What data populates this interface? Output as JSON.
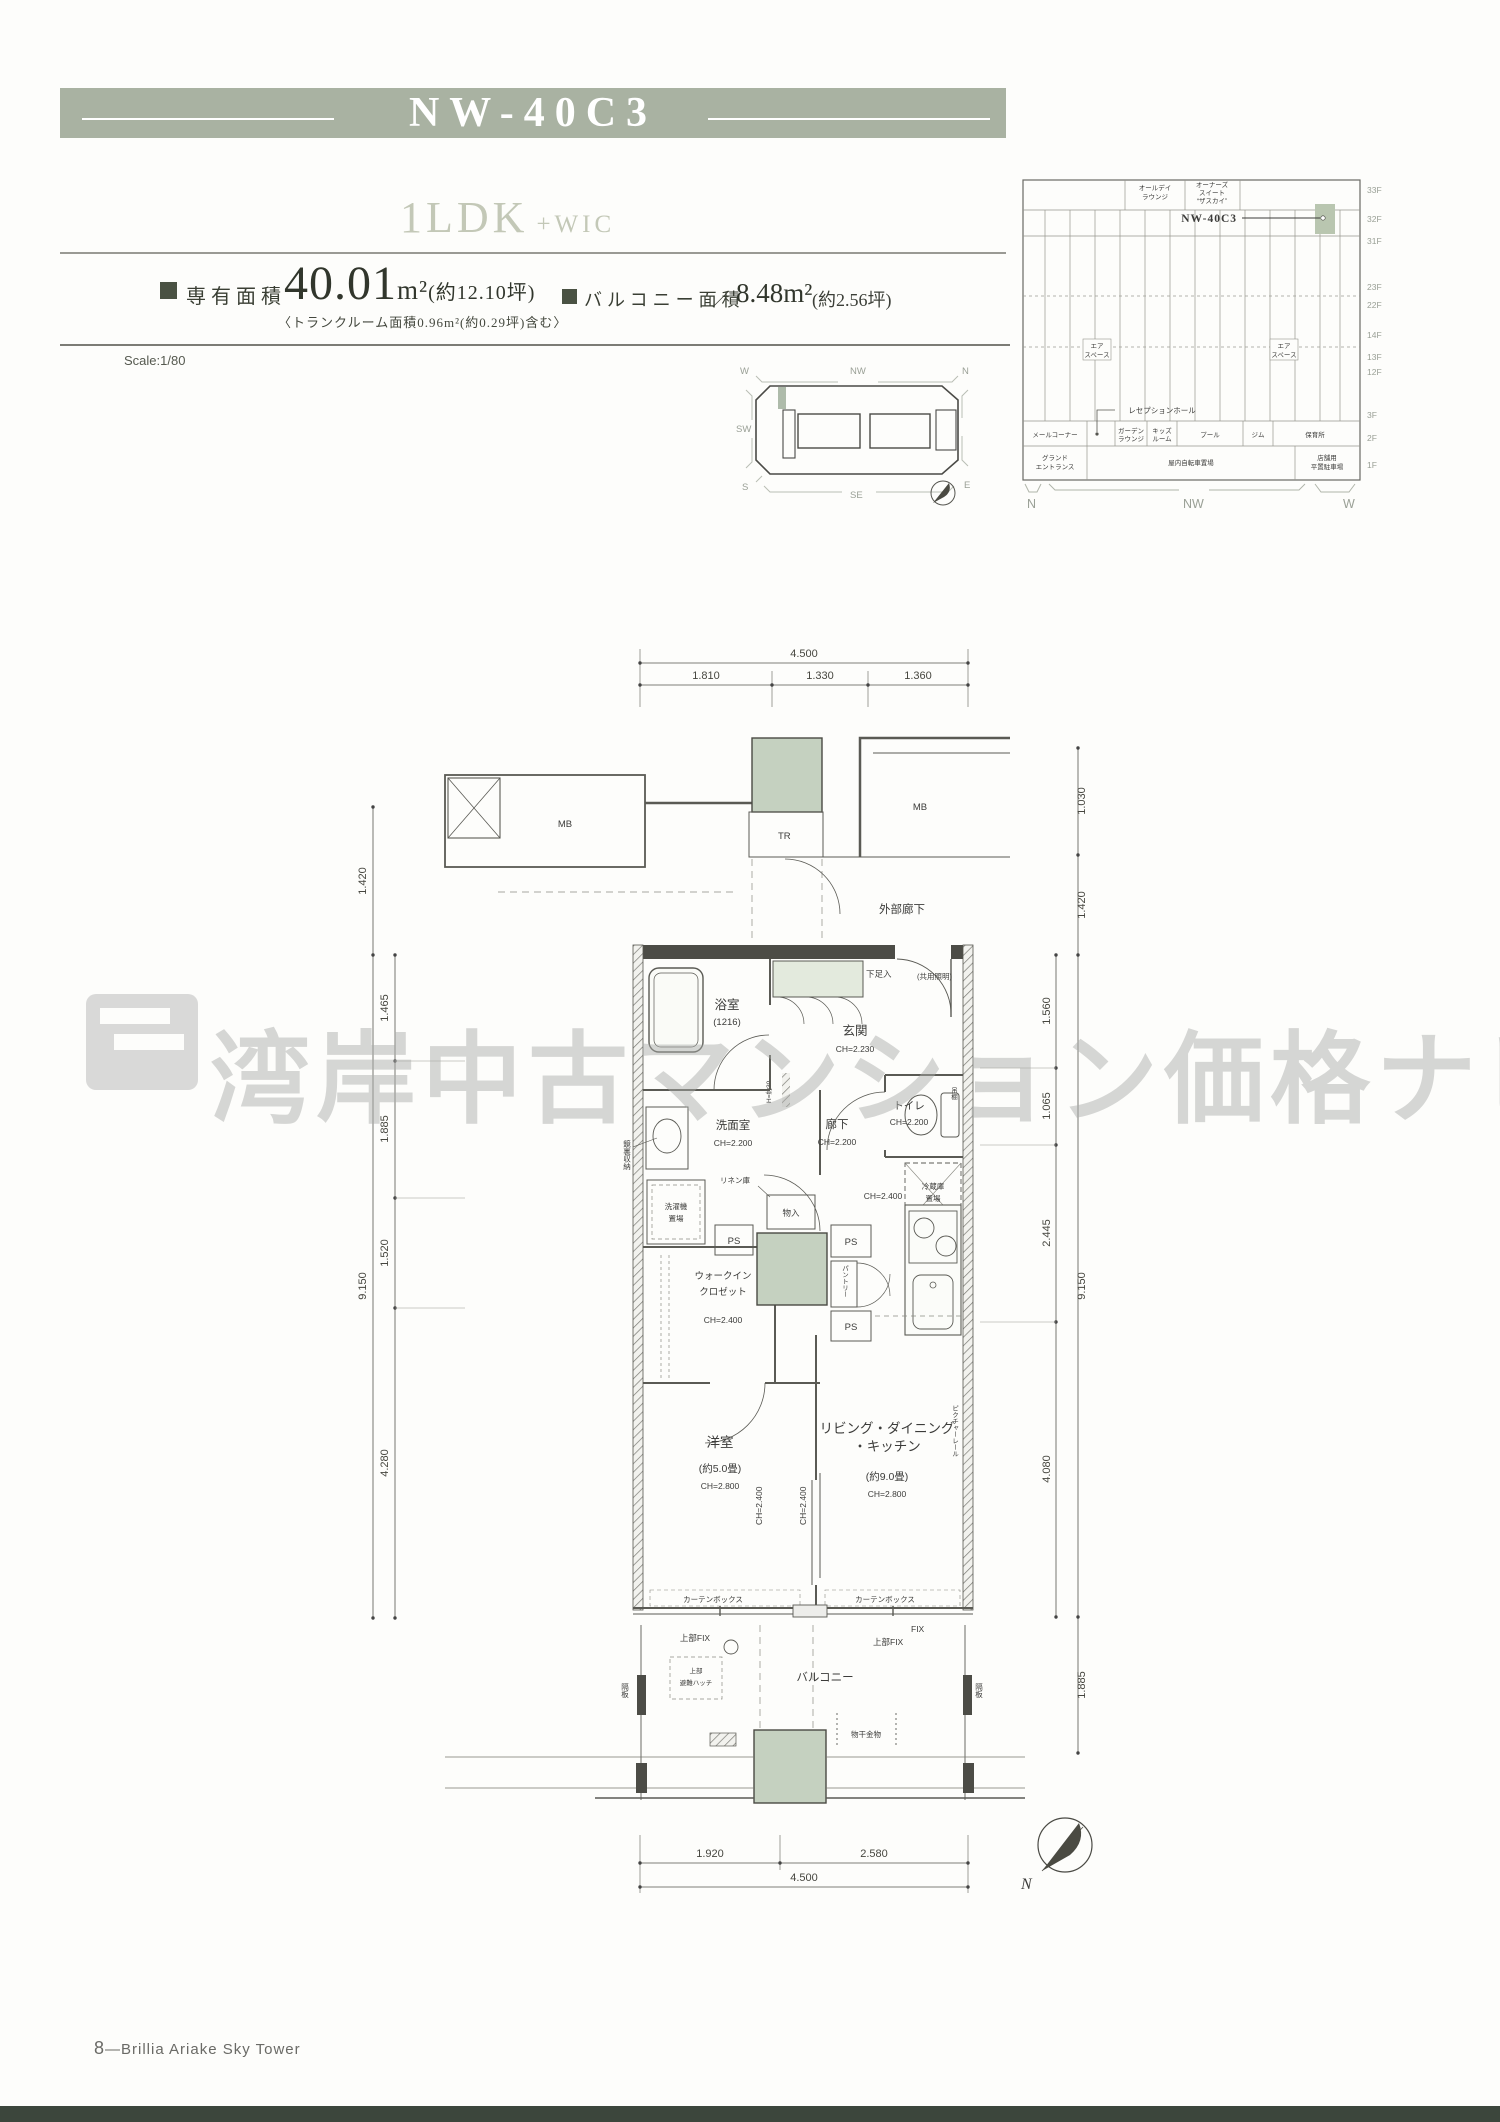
{
  "header": {
    "unit_code": "NW-40C3",
    "plan_type": "1LDK",
    "plan_suffix": "+WIC"
  },
  "specs": {
    "area_label": "専有面積",
    "area_value": "40.01",
    "area_unit": "m²",
    "area_tsubo": "(約12.10坪)",
    "trunk_note": "〈トランクルーム面積0.96m²(約0.29坪)含む〉",
    "balcony_label": "バルコニー面積",
    "separator": "／",
    "balcony_value": "8.48m²",
    "balcony_tsubo": "(約2.56坪)",
    "scale": "Scale:1/80"
  },
  "keyplan": {
    "w": "W",
    "nw": "NW",
    "n": "N",
    "sw": "SW",
    "s": "S",
    "se": "SE",
    "e": "E"
  },
  "elevation": {
    "unit_label": "NW-40C3",
    "floors": [
      "33F",
      "32F",
      "31F",
      "23F",
      "22F",
      "14F",
      "13F",
      "12F",
      "3F",
      "2F",
      "1F"
    ],
    "allday": [
      "オールデイ",
      "ラウンジ"
    ],
    "owners": [
      "オーナーズ",
      "スイート",
      "“ザスカイ”"
    ],
    "airspace": [
      "エア",
      "スペース"
    ],
    "reception": "レセプションホール",
    "f2": [
      "メールコーナー",
      "ガーデン",
      "ラウンジ",
      "キッズ",
      "ルーム",
      "プール",
      "ジム",
      "保育所"
    ],
    "f1": [
      "グランド",
      "エントランス",
      "屋内自転車置場",
      "店舗用",
      "平置駐車場"
    ],
    "dir_n": "N",
    "dir_nw": "NW",
    "dir_w": "W"
  },
  "plan": {
    "dims": {
      "top_total": "4.500",
      "top": [
        "1.810",
        "1.330",
        "1.360"
      ],
      "left_outer": [
        "1.420",
        "9.150"
      ],
      "left_inner": [
        "1.465",
        "1.885",
        "1.520",
        "4.280"
      ],
      "right_outer": [
        "1.030",
        "1.420",
        "9.150",
        "1.885"
      ],
      "right_inner": [
        "1.560",
        "1.065",
        "2.445",
        "4.080"
      ],
      "bottom": [
        "1.920",
        "2.580"
      ],
      "bottom_total": "4.500"
    },
    "labels": {
      "corridor": "外部廊下",
      "mb": "MB",
      "tr": "TR",
      "bath": "浴室",
      "bath_size": "(1216)",
      "entrance": "玄関",
      "entrance_ch": "CH=2.230",
      "shoe": "下足入",
      "common_light": "(共用照明)",
      "step": "H=約30",
      "washroom": "洗面室",
      "ch2200": "CH=2.200",
      "hall": "廊下",
      "toilet": "トイレ",
      "washer1": "洗濯機",
      "washer2": "置場",
      "linen": "リネン庫",
      "fridge1": "冷蔵庫",
      "fridge2": "置場",
      "ch2400": "CH=2.400",
      "hang_shelf": "吊棚",
      "mirror": "鏡裏収納",
      "wic1": "ウォークイン",
      "wic2": "クロゼット",
      "closet": "物入",
      "pantry": "パントリー",
      "ps": "PS",
      "bedroom": "洋室",
      "bedroom_size": "(約5.0畳)",
      "ch2800": "CH=2.800",
      "ldk1": "リビング・ダイニング",
      "ldk2": "・キッチン",
      "ldk_size": "(約9.0畳)",
      "picture_rail": "ピクチャーレール",
      "curtain": "カーテンボックス",
      "fix_upper": "上部FIX",
      "fix": "FIX",
      "balcony": "バルコニー",
      "hatch1": "上部",
      "hatch2": "避難ハッチ",
      "partition": "隔板",
      "laundry": "物干金物",
      "north": "N"
    }
  },
  "watermark": {
    "text": "湾岸中古マンション価格ナビ"
  },
  "footer": {
    "page_no": "8",
    "dash": "—",
    "title": "Brillia Ariake Sky Tower"
  }
}
